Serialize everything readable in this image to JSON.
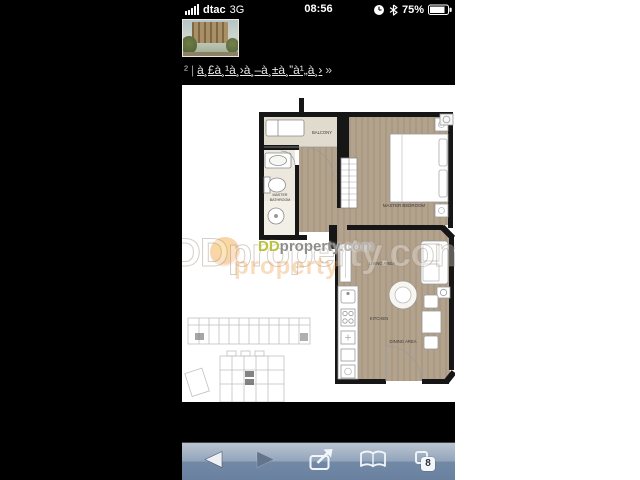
{
  "status_bar": {
    "carrier": "dtac",
    "network": "3G",
    "time": "08:56",
    "battery": "75%",
    "icons": [
      "signal-bars-icon",
      "alarm-clock-icon",
      "bluetooth-icon",
      "battery-icon"
    ]
  },
  "header": {
    "prefix": "²",
    "separator": "|",
    "link_text": "à¸£à¸¹à¸›à¸–à¸±à¸”à¹„à¸›",
    "suffix": "»"
  },
  "floor_plan": {
    "labels": {
      "balcony": "BALCONY",
      "master_bathroom_1": "MASTER",
      "master_bathroom_2": "BATHROOM",
      "master_bedroom": "MASTER BEDROOM",
      "living_area": "LIVING AREA",
      "kitchen": "KITCHEN",
      "dining_area": "DINING AREA"
    }
  },
  "watermark": {
    "big": "DDproperty.com",
    "orange_echo": "property",
    "dd": "DD",
    "name": "property",
    "tld": ".com"
  },
  "toolbar": {
    "tabs_count": "8",
    "icons": [
      "back-icon",
      "forward-icon",
      "share-icon",
      "bookmarks-icon",
      "pages-icon"
    ]
  },
  "colors": {
    "wall": "#161616",
    "wood_floor": "#b3a28c",
    "bathroom_floor": "#ece8dd",
    "balcony_floor": "#e1dbcd",
    "toolbar_top": "#bac4d1",
    "toolbar_bottom": "#69809f",
    "watermark_dd": "#b9c23a",
    "watermark_gray": "#8e8e8e",
    "watermark_orange": "#e78c28"
  }
}
